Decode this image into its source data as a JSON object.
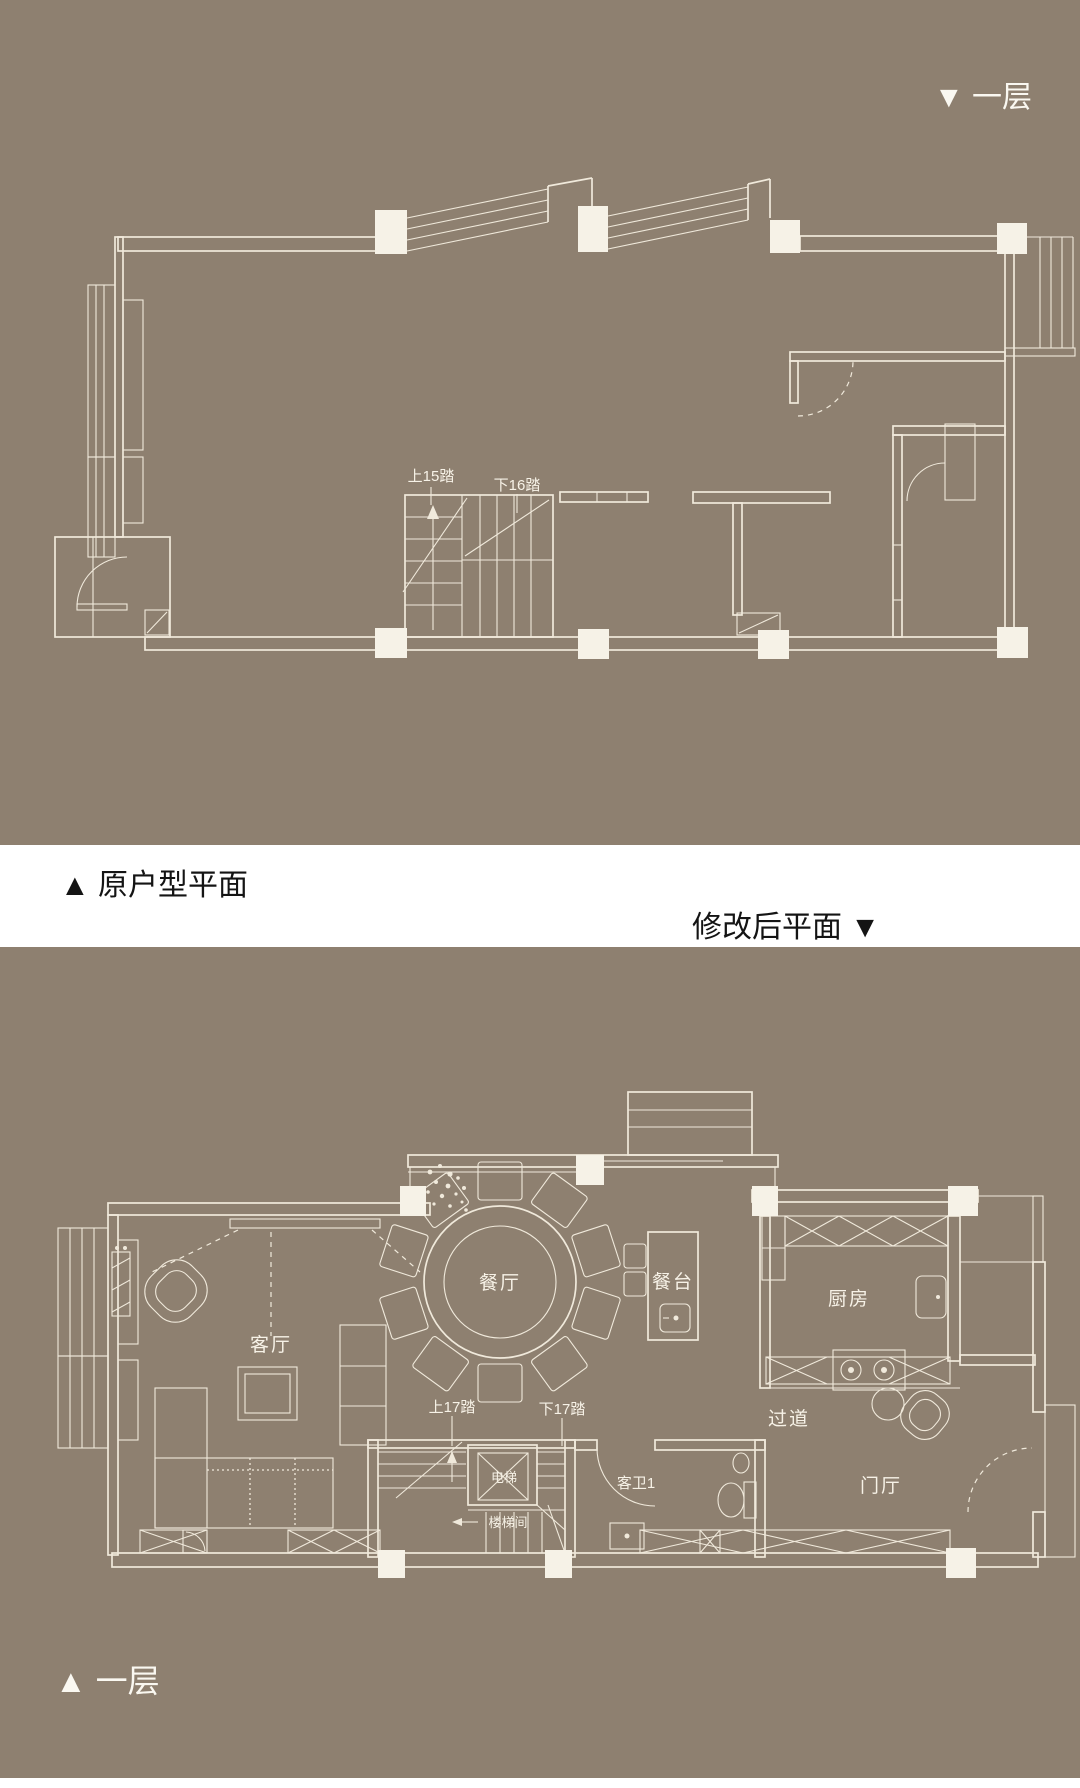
{
  "colors": {
    "background": "#8e8070",
    "line": "#f0e9db",
    "column_fill": "#f6f2e7",
    "band_background": "#ffffff",
    "caption_dark": "#141414",
    "caption_light": "#faf8f1"
  },
  "captions": {
    "top_plan_tag": "▼ 一层",
    "original_plan_label": "▲ 原户型平面",
    "modified_plan_label": "修改后平面 ▼",
    "bottom_plan_tag": "▲ 一层"
  },
  "top_plan": {
    "labels": {
      "stairs_up": "上15踏",
      "stairs_down": "下16踏"
    }
  },
  "bottom_plan": {
    "labels": {
      "dining": "餐厅",
      "bar": "餐台",
      "kitchen": "厨房",
      "living": "客厅",
      "corridor": "过道",
      "stairs_up": "上17踏",
      "stairs_down": "下17踏",
      "elevator": "电梯",
      "guest_bath": "客卫1",
      "foyer": "门厅",
      "stairwell": "楼梯间"
    }
  }
}
